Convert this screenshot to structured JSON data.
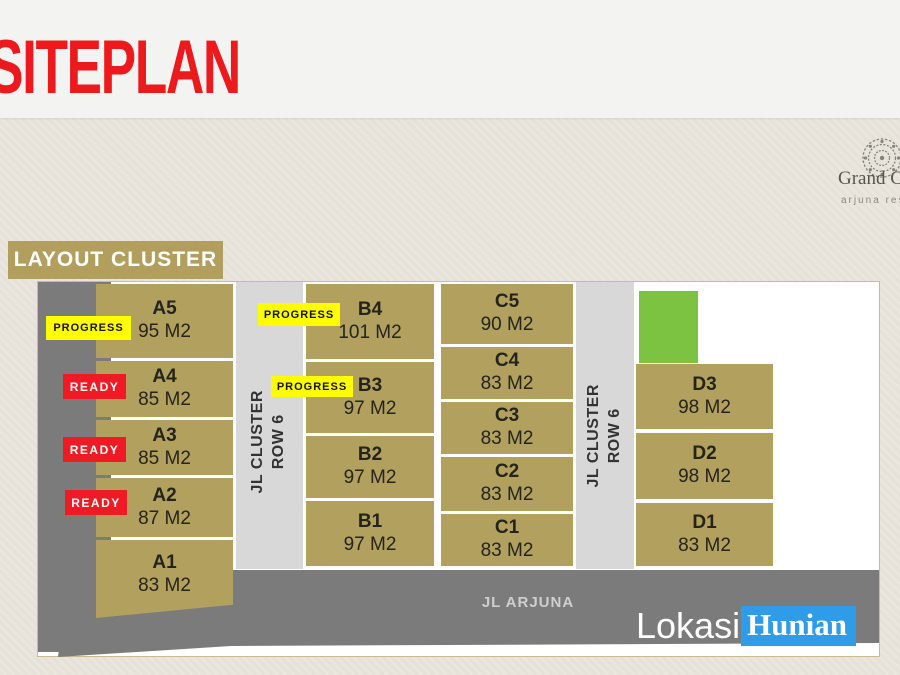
{
  "slide": {
    "title": "SITEPLAN"
  },
  "brand": {
    "name": "Grand Ca",
    "tagline": "arjuna resi",
    "icon": "mandala-icon"
  },
  "plan": {
    "heading": "LAYOUT CLUSTER",
    "roads": {
      "cluster_line1": "JL CLUSTER",
      "cluster_line2": "ROW 6",
      "main": "JL ARJUNA"
    },
    "statuses": {
      "progress": "PROGRESS",
      "ready": "READY"
    },
    "columns": {
      "a": [
        {
          "id": "A5",
          "area": "95 M2",
          "status": "PROGRESS"
        },
        {
          "id": "A4",
          "area": "85 M2",
          "status": "READY"
        },
        {
          "id": "A3",
          "area": "85 M2",
          "status": "READY"
        },
        {
          "id": "A2",
          "area": "87 M2",
          "status": "READY"
        },
        {
          "id": "A1",
          "area": "83 M2",
          "status": ""
        }
      ],
      "b": [
        {
          "id": "B4",
          "area": "101 M2",
          "status": "PROGRESS"
        },
        {
          "id": "B3",
          "area": "97 M2",
          "status": "PROGRESS"
        },
        {
          "id": "B2",
          "area": "97 M2",
          "status": ""
        },
        {
          "id": "B1",
          "area": "97 M2",
          "status": ""
        }
      ],
      "c": [
        {
          "id": "C5",
          "area": "90 M2",
          "status": ""
        },
        {
          "id": "C4",
          "area": "83 M2",
          "status": ""
        },
        {
          "id": "C3",
          "area": "83 M2",
          "status": ""
        },
        {
          "id": "C2",
          "area": "83 M2",
          "status": ""
        },
        {
          "id": "C1",
          "area": "83 M2",
          "status": ""
        }
      ],
      "d": [
        {
          "id": "D3",
          "area": "98 M2",
          "status": ""
        },
        {
          "id": "D2",
          "area": "98 M2",
          "status": ""
        },
        {
          "id": "D1",
          "area": "83 M2",
          "status": ""
        }
      ]
    }
  },
  "watermark": {
    "part1": "Lokasi",
    "part2": "Hunian"
  },
  "colors": {
    "title_red": "#ec1a1d",
    "plot_tan": "#b2a05f",
    "heading_tan": "#b29f5d",
    "road_light": "#d8d8d8",
    "road_dark": "#7b7b7b",
    "green_plot": "#7cc342",
    "progress_bg": "#fdfd00",
    "ready_bg": "#ee1b24",
    "watermark_blue": "#2e9ce8"
  }
}
